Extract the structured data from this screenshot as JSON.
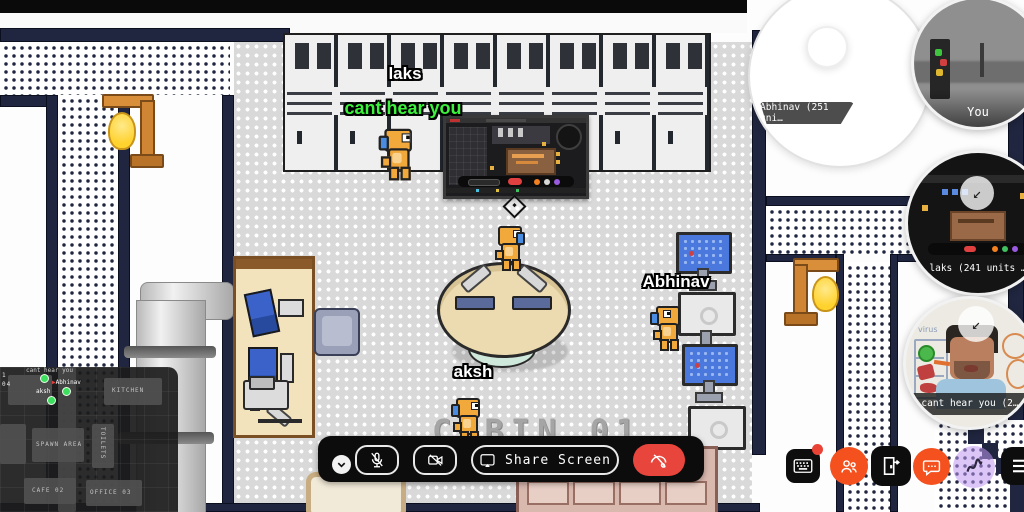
{
  "players": {
    "laks": {
      "name": "laks",
      "speech": "cant hear you"
    },
    "aksh": {
      "name": "aksh"
    },
    "abhinav": {
      "name": "Abhinav"
    }
  },
  "map": {
    "floor_label": "CABIN 01"
  },
  "call_toolbar": {
    "share_screen_label": "Share Screen",
    "icons": [
      "chevron-down",
      "mic-off",
      "camera-off",
      "share-screen",
      "phone-off"
    ]
  },
  "participants": {
    "you": {
      "label": "You"
    },
    "laks_screen": {
      "label": "laks (241 units …"
    },
    "abhinav": {
      "label": "Abhinav (251 uni…"
    },
    "speaker": {
      "label": "cant hear you (2…",
      "whiteboard_text": "virus"
    }
  },
  "minimap": {
    "rooms": [
      {
        "label": "KITCHEN"
      },
      {
        "label": "SPAWN AREA"
      },
      {
        "label": "TOILETS"
      },
      {
        "label": "CAFE 02"
      },
      {
        "label": "OFFICE 03"
      }
    ],
    "markers": [
      {
        "label": "cant hear you"
      },
      {
        "label": "Abhinav"
      },
      {
        "label": "aksh"
      }
    ],
    "edge_labels": [
      "1",
      "04"
    ]
  },
  "action_bar": {
    "icons": [
      "keyboard",
      "people",
      "exit-door",
      "chat",
      "wave",
      "menu"
    ]
  },
  "icons": {
    "play_marker": "▶",
    "collapse_arrow": "↙"
  },
  "colors": {
    "danger": "#e8453c",
    "orange": "#f4511e",
    "purple": "#c9aaf0",
    "speech_green": "#3cf23c",
    "marker_green": "#3ede5e",
    "wall_navy": "#20263f"
  }
}
